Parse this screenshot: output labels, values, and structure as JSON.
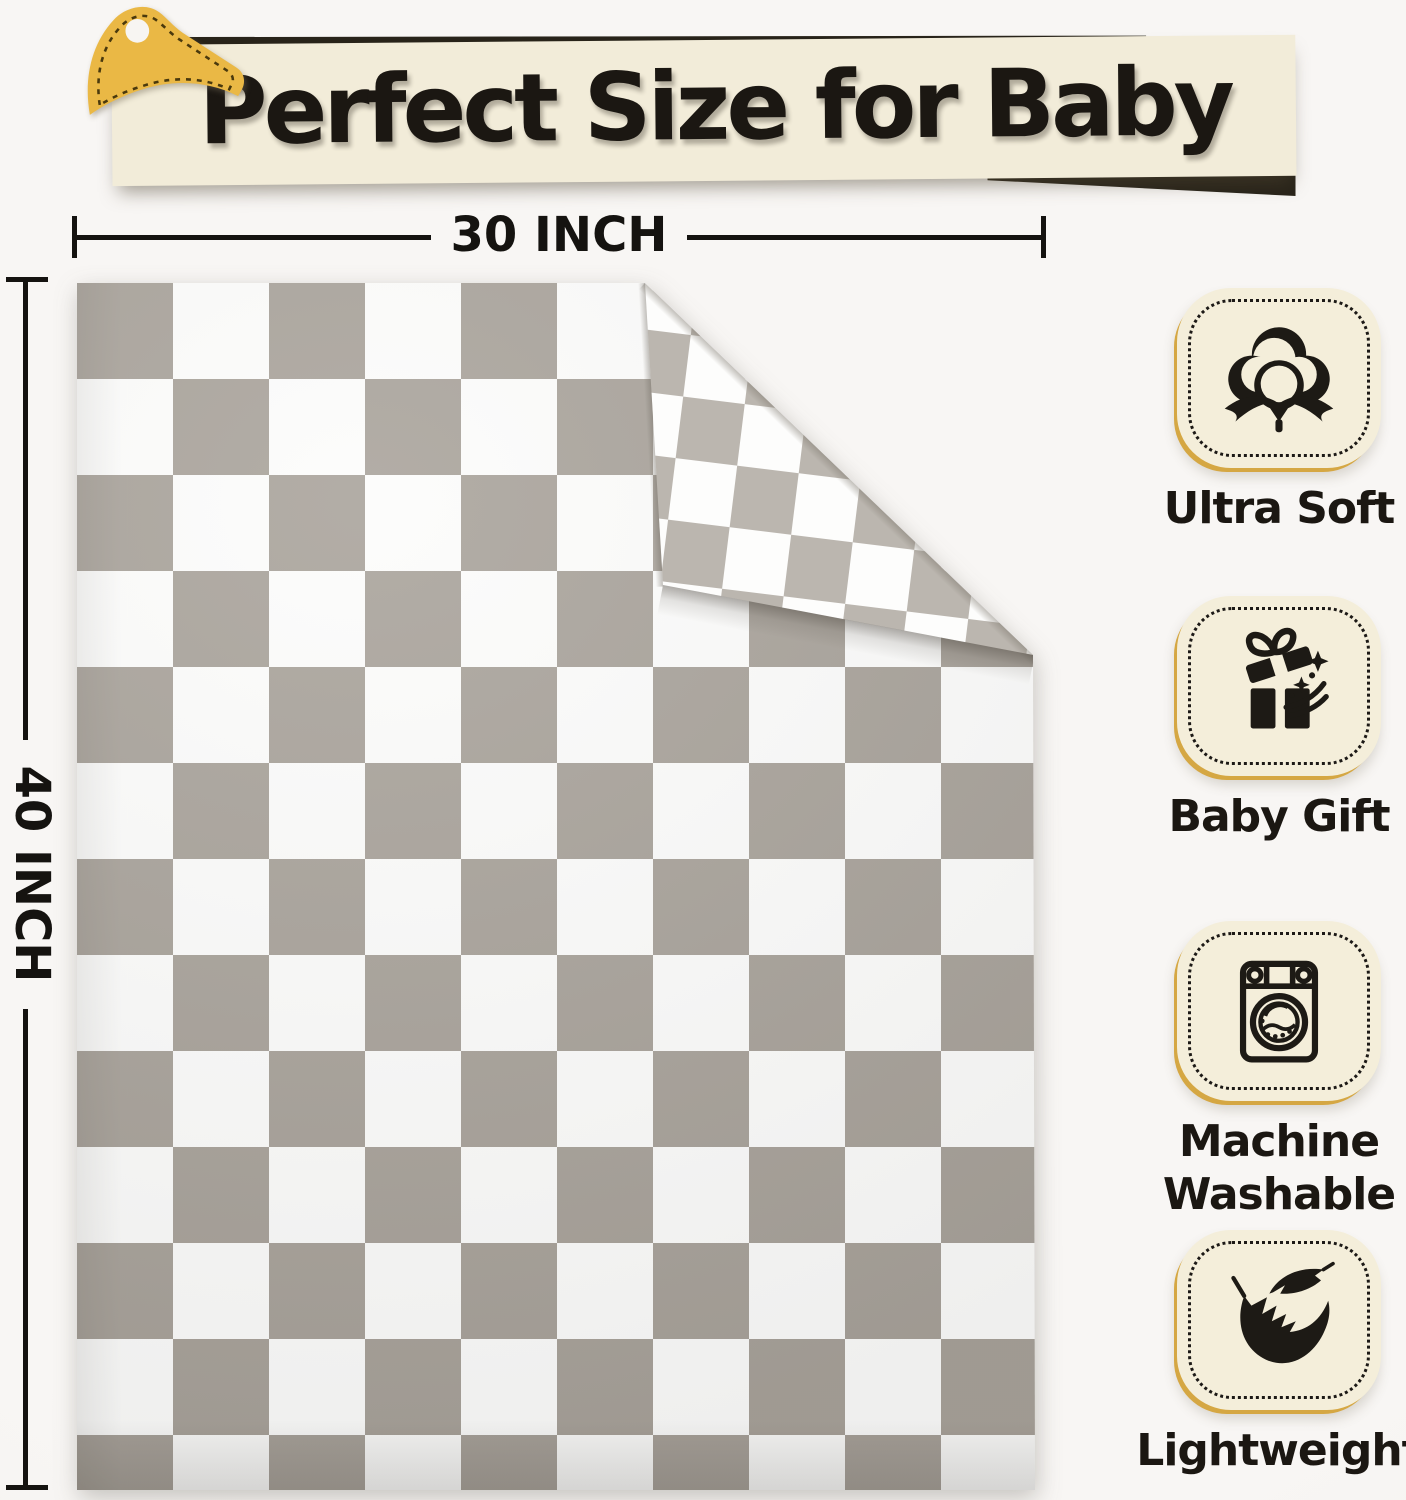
{
  "banner": {
    "title": "Perfect Size for Baby"
  },
  "dimensions": {
    "width_label": "30 INCH",
    "height_label": "40 INCH"
  },
  "features": [
    {
      "label": "Ultra Soft",
      "icon": "cotton-icon"
    },
    {
      "label": "Baby Gift",
      "icon": "gift-box-icon"
    },
    {
      "label": "Machine Washable",
      "icon": "washing-machine-icon"
    },
    {
      "label": "Lightweight",
      "icon": "feathers-icon"
    }
  ],
  "theme": {
    "page_bg": "#f7f5f2",
    "ink": "#1b1712",
    "dim_ink": "#151310",
    "banner_bg": "#f2ecd9",
    "banner_accent": "#29241a",
    "clip_gold": "#eab845",
    "clip_stitch": "#4a390d",
    "badge_bg": "#f4eeda",
    "badge_rim": "#d5a743",
    "badge_dot": "#1c1916",
    "icon_ink": "#1d1a15",
    "blanket_gray": "#a8a29a",
    "blanket_white": "#fcfcfb",
    "flap_gray": "#b2aca4",
    "flap_white": "#fdfdfc"
  }
}
